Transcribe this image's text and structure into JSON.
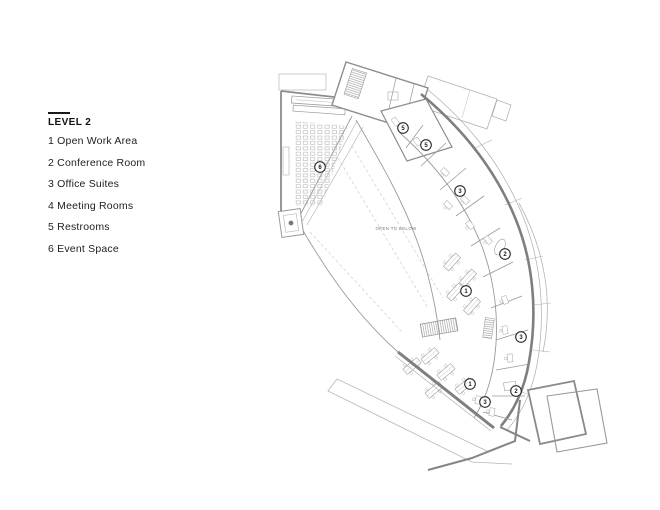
{
  "legend": {
    "title": "LEVEL 2",
    "items": [
      {
        "label": "1 Open Work Area"
      },
      {
        "label": "2 Conference Room"
      },
      {
        "label": "3 Office Suites"
      },
      {
        "label": "4 Meeting Rooms"
      },
      {
        "label": "5 Restrooms"
      },
      {
        "label": "6 Event Space"
      }
    ]
  },
  "plan": {
    "open_to_below_label": "OPEN TO BELOW",
    "markers": [
      {
        "num": "6",
        "x": 320,
        "y": 167
      },
      {
        "num": "5",
        "x": 403,
        "y": 128
      },
      {
        "num": "5",
        "x": 426,
        "y": 145
      },
      {
        "num": "3",
        "x": 460,
        "y": 191
      },
      {
        "num": "2",
        "x": 505,
        "y": 254
      },
      {
        "num": "1",
        "x": 466,
        "y": 291
      },
      {
        "num": "3",
        "x": 521,
        "y": 337
      },
      {
        "num": "1",
        "x": 470,
        "y": 384
      },
      {
        "num": "3",
        "x": 485,
        "y": 402
      },
      {
        "num": "2",
        "x": 516,
        "y": 391
      }
    ]
  },
  "colors": {
    "wall_heavy": "#7f7f7f",
    "wall": "#8d8d8d",
    "line": "#9a9a9a",
    "light_line": "#b8b8b8",
    "legend_text": "#222222",
    "marker_stroke": "#2a2a2a"
  }
}
